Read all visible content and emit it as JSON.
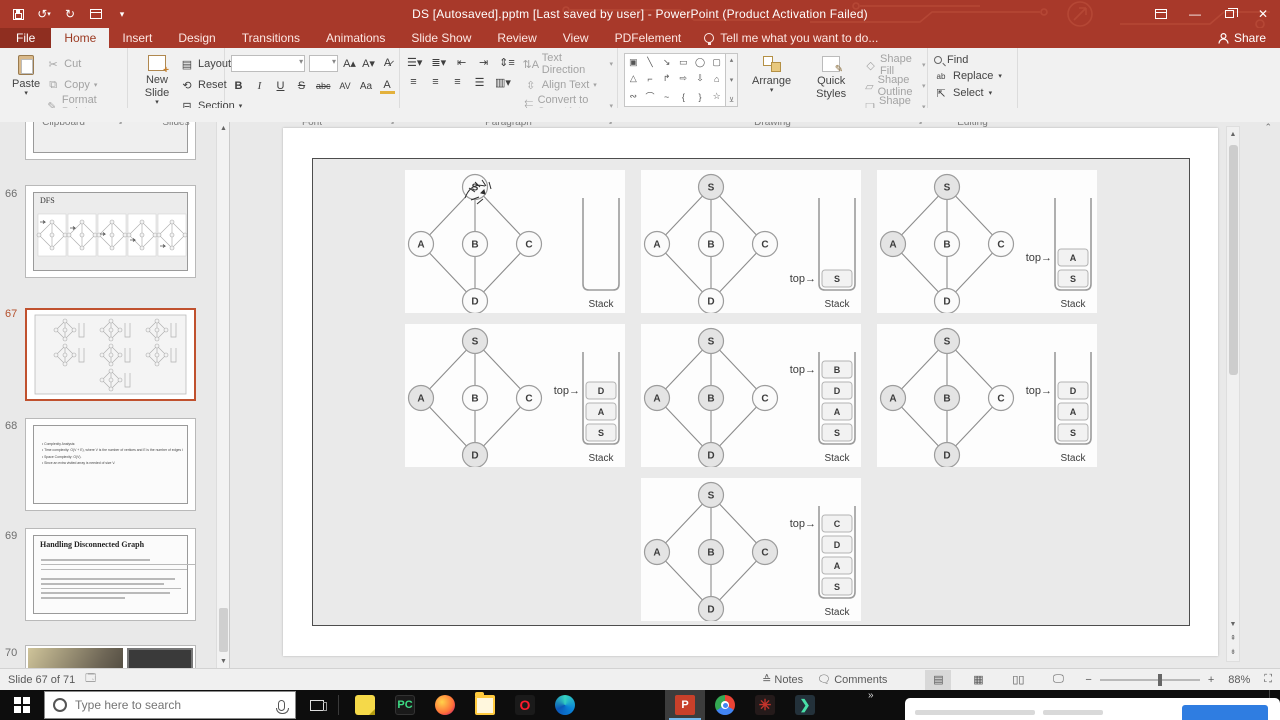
{
  "titlebar": {
    "title": "DS [Autosaved].pptm [Last saved by user] - PowerPoint (Product Activation Failed)",
    "quick_access_icons": [
      "save-icon",
      "undo-icon",
      "redo-icon",
      "slideshow-icon",
      "customize-quick-access-icon"
    ]
  },
  "ribbon": {
    "tabs": [
      {
        "label": "File",
        "active": false,
        "is_file": true
      },
      {
        "label": "Home",
        "active": true
      },
      {
        "label": "Insert",
        "active": false
      },
      {
        "label": "Design",
        "active": false
      },
      {
        "label": "Transitions",
        "active": false
      },
      {
        "label": "Animations",
        "active": false
      },
      {
        "label": "Slide Show",
        "active": false
      },
      {
        "label": "Review",
        "active": false
      },
      {
        "label": "View",
        "active": false
      },
      {
        "label": "PDFelement",
        "active": false
      }
    ],
    "tell_me": "Tell me what you want to do...",
    "share_label": "Share",
    "clipboard": {
      "group": "Clipboard",
      "paste": "Paste",
      "cut": "Cut",
      "copy": "Copy",
      "format_painter": "Format Painter"
    },
    "slides_group": {
      "group": "Slides",
      "new_slide": "New Slide",
      "layout": "Layout",
      "reset": "Reset",
      "section": "Section"
    },
    "font_group": {
      "group": "Font",
      "bold": "B",
      "italic": "I",
      "underline": "U",
      "strike": "S",
      "abc": "abc",
      "av": "AV",
      "aa": "Aa",
      "color": "A",
      "grow": "A",
      "shrink": "A",
      "clear": "A"
    },
    "paragraph_group": {
      "group": "Paragraph",
      "text_direction": "Text Direction",
      "align_text": "Align Text",
      "smartart": "Convert to SmartArt"
    },
    "drawing_group": {
      "group": "Drawing",
      "arrange": "Arrange",
      "quick_styles": "Quick Styles",
      "shape_fill": "Shape Fill",
      "shape_outline": "Shape Outline",
      "shape_effects": "Shape Effects",
      "shape_glyphs": [
        "▣",
        "╲",
        "↘",
        "▭",
        "◯",
        "▢",
        "△",
        "⌐",
        "↱",
        "⇨",
        "⇩",
        "⌂",
        "∾",
        "⌒",
        "~",
        "{",
        "}",
        "☆"
      ]
    },
    "editing_group": {
      "group": "Editing",
      "find": "Find",
      "replace": "Replace",
      "select": "Select"
    }
  },
  "sidebar": {
    "slides": [
      {
        "number": "66",
        "kind": "dfs",
        "title": "DFS"
      },
      {
        "number": "67",
        "kind": "current",
        "selected": true
      },
      {
        "number": "68",
        "kind": "text",
        "lines": [
          "Complexity Analysis:",
          "Time complexity: O(V + E), where V is the number of vertices and E is the number of edges in the graph.",
          "Space Complexity: O(V).",
          "Since an extra visited array is needed of size V."
        ]
      },
      {
        "number": "69",
        "kind": "title-text",
        "title": "Handling Disconnected Graph"
      },
      {
        "number": "70",
        "kind": "image"
      }
    ]
  },
  "slide_canvas": {
    "graph": {
      "nodes": [
        "S",
        "A",
        "B",
        "C",
        "D"
      ],
      "edges": [
        [
          "S",
          "A"
        ],
        [
          "S",
          "B"
        ],
        [
          "S",
          "C"
        ],
        [
          "A",
          "D"
        ],
        [
          "B",
          "D"
        ],
        [
          "C",
          "D"
        ]
      ],
      "top_label": "top→",
      "stack_label": "Stack"
    },
    "steps": [
      {
        "visited": [],
        "stack": [],
        "ink_cursor": true
      },
      {
        "visited": [
          "S"
        ],
        "stack": [
          "S"
        ]
      },
      {
        "visited": [
          "S",
          "A"
        ],
        "stack": [
          "A",
          "S"
        ]
      },
      {
        "visited": [
          "S",
          "A",
          "D"
        ],
        "stack": [
          "D",
          "A",
          "S"
        ]
      },
      {
        "visited": [
          "S",
          "A",
          "B",
          "D"
        ],
        "stack": [
          "B",
          "D",
          "A",
          "S"
        ]
      },
      {
        "visited": [
          "S",
          "A",
          "B",
          "D"
        ],
        "stack": [
          "D",
          "A",
          "S"
        ]
      },
      {
        "visited": [
          "S",
          "A",
          "B",
          "C",
          "D"
        ],
        "stack": [
          "C",
          "D",
          "A",
          "S"
        ]
      }
    ]
  },
  "statusbar": {
    "slide_info": "Slide 67 of 71",
    "notes": "Notes",
    "comments": "Comments",
    "zoom_percent": "88%"
  },
  "taskbar": {
    "search_placeholder": "Type here to search",
    "clock": "3:56 PM",
    "overflow_chevron": "»",
    "apps_pinned": [
      "sticky-notes",
      "pycharm",
      "firefox",
      "file-explorer",
      "opera",
      "edge"
    ],
    "apps_running": [
      "powerpoint",
      "chrome",
      "red-star-app",
      "filmora"
    ],
    "pycharm_label": "PC",
    "powerpoint_label": "P",
    "opera_label": "O"
  },
  "colors": {
    "brand_red": "#a8392a",
    "selected_slide_border": "#c0512e",
    "visited_node_fill": "#e4e4e4",
    "unvisited_node_fill": "#fbfbfb",
    "notification_button_blue": "#2f7de1"
  }
}
